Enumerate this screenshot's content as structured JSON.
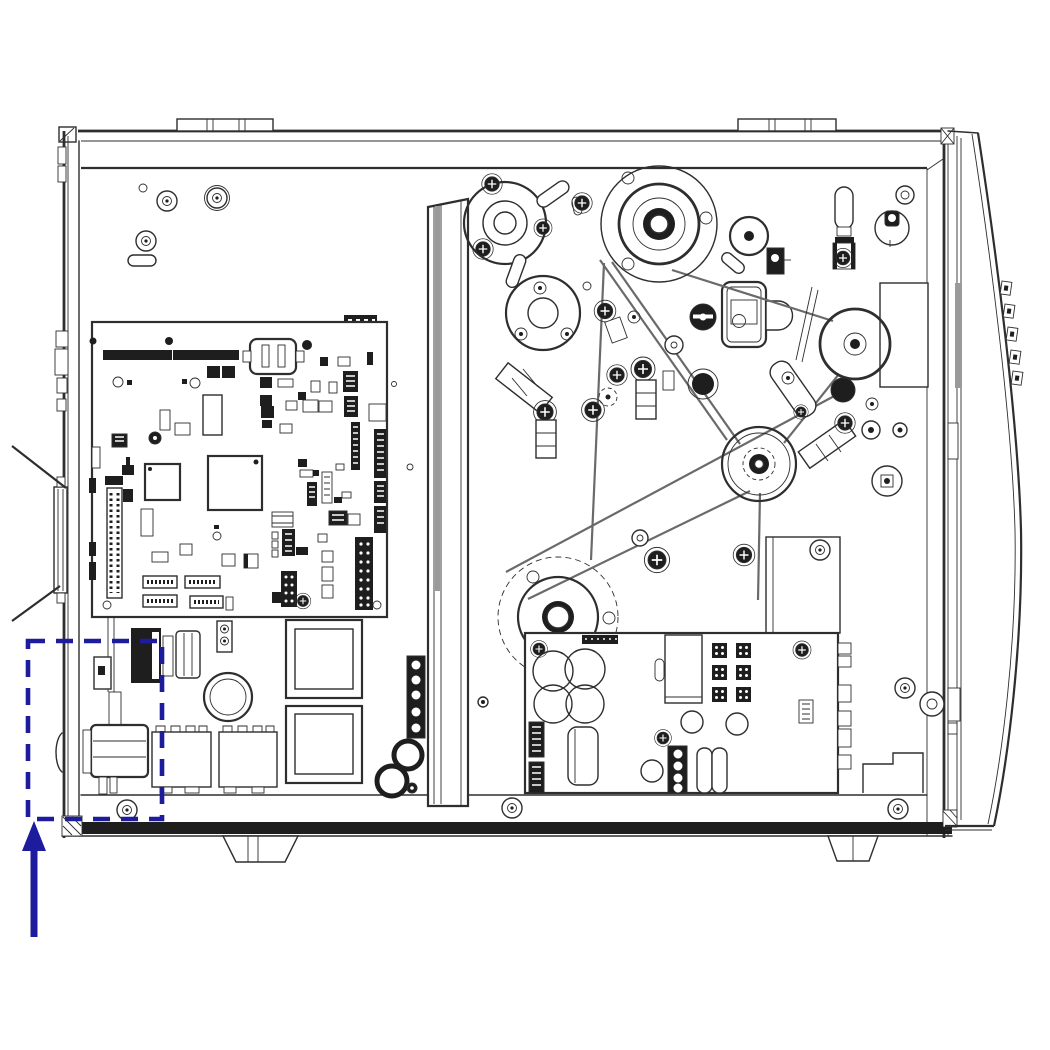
{
  "figure": {
    "kind": "technical-line-illustration",
    "subject": "printer-electronics-bay-side-view",
    "colors": {
      "background": "#ffffff",
      "line": "#2e2e2e",
      "dark_fill": "#1e1e1e",
      "gray_fill": "#9a9a9a",
      "belt": "#6a6a6a",
      "highlight": "#1c1c9c"
    },
    "annotation": {
      "shape": "dashed-rectangle",
      "pointer": "up-arrow",
      "color": "#1c1c9c",
      "target": "power-entry-region"
    }
  }
}
